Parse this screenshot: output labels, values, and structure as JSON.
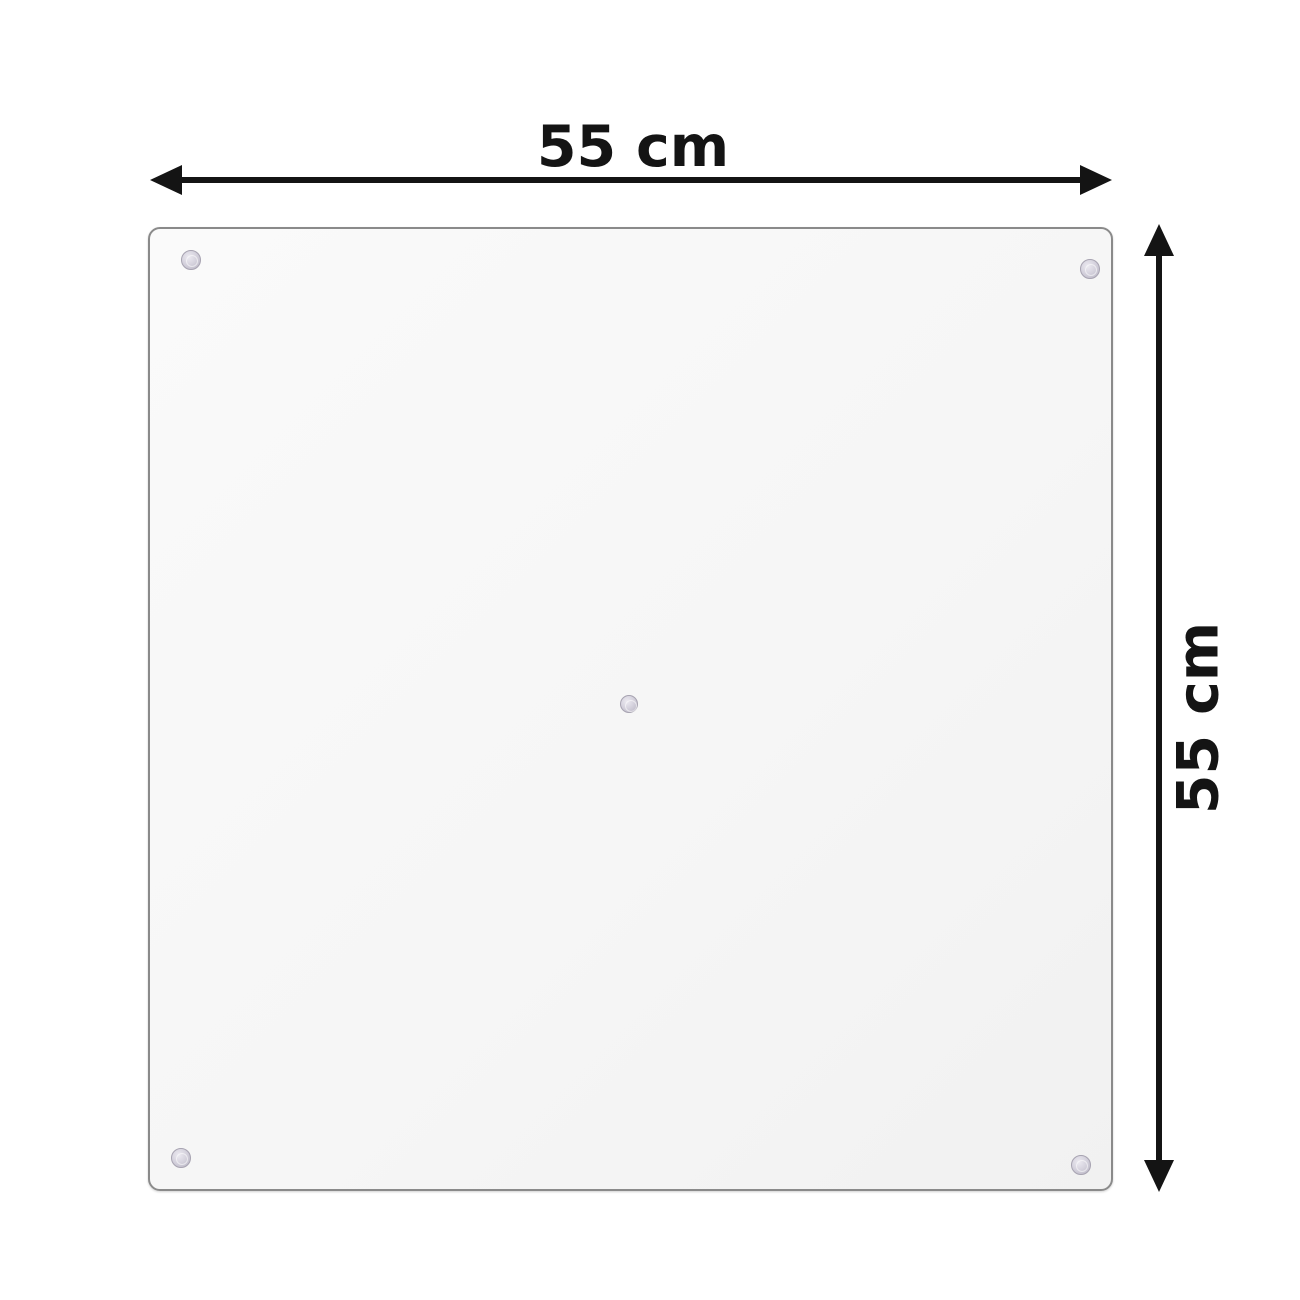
{
  "diagram": {
    "type": "product-dimension-diagram",
    "background_color": "#ffffff",
    "dimensions": {
      "width_label": "55 cm",
      "height_label": "55 cm"
    },
    "arrow_color": "#141414",
    "panel": {
      "fill_color": "#f6f6f6",
      "border_color": "#8a8a8a",
      "suction_cup_color": "#c9c5d3",
      "mount_points": [
        {
          "position": "top-left"
        },
        {
          "position": "top-right"
        },
        {
          "position": "bottom-left"
        },
        {
          "position": "bottom-right"
        },
        {
          "position": "center"
        }
      ]
    }
  }
}
